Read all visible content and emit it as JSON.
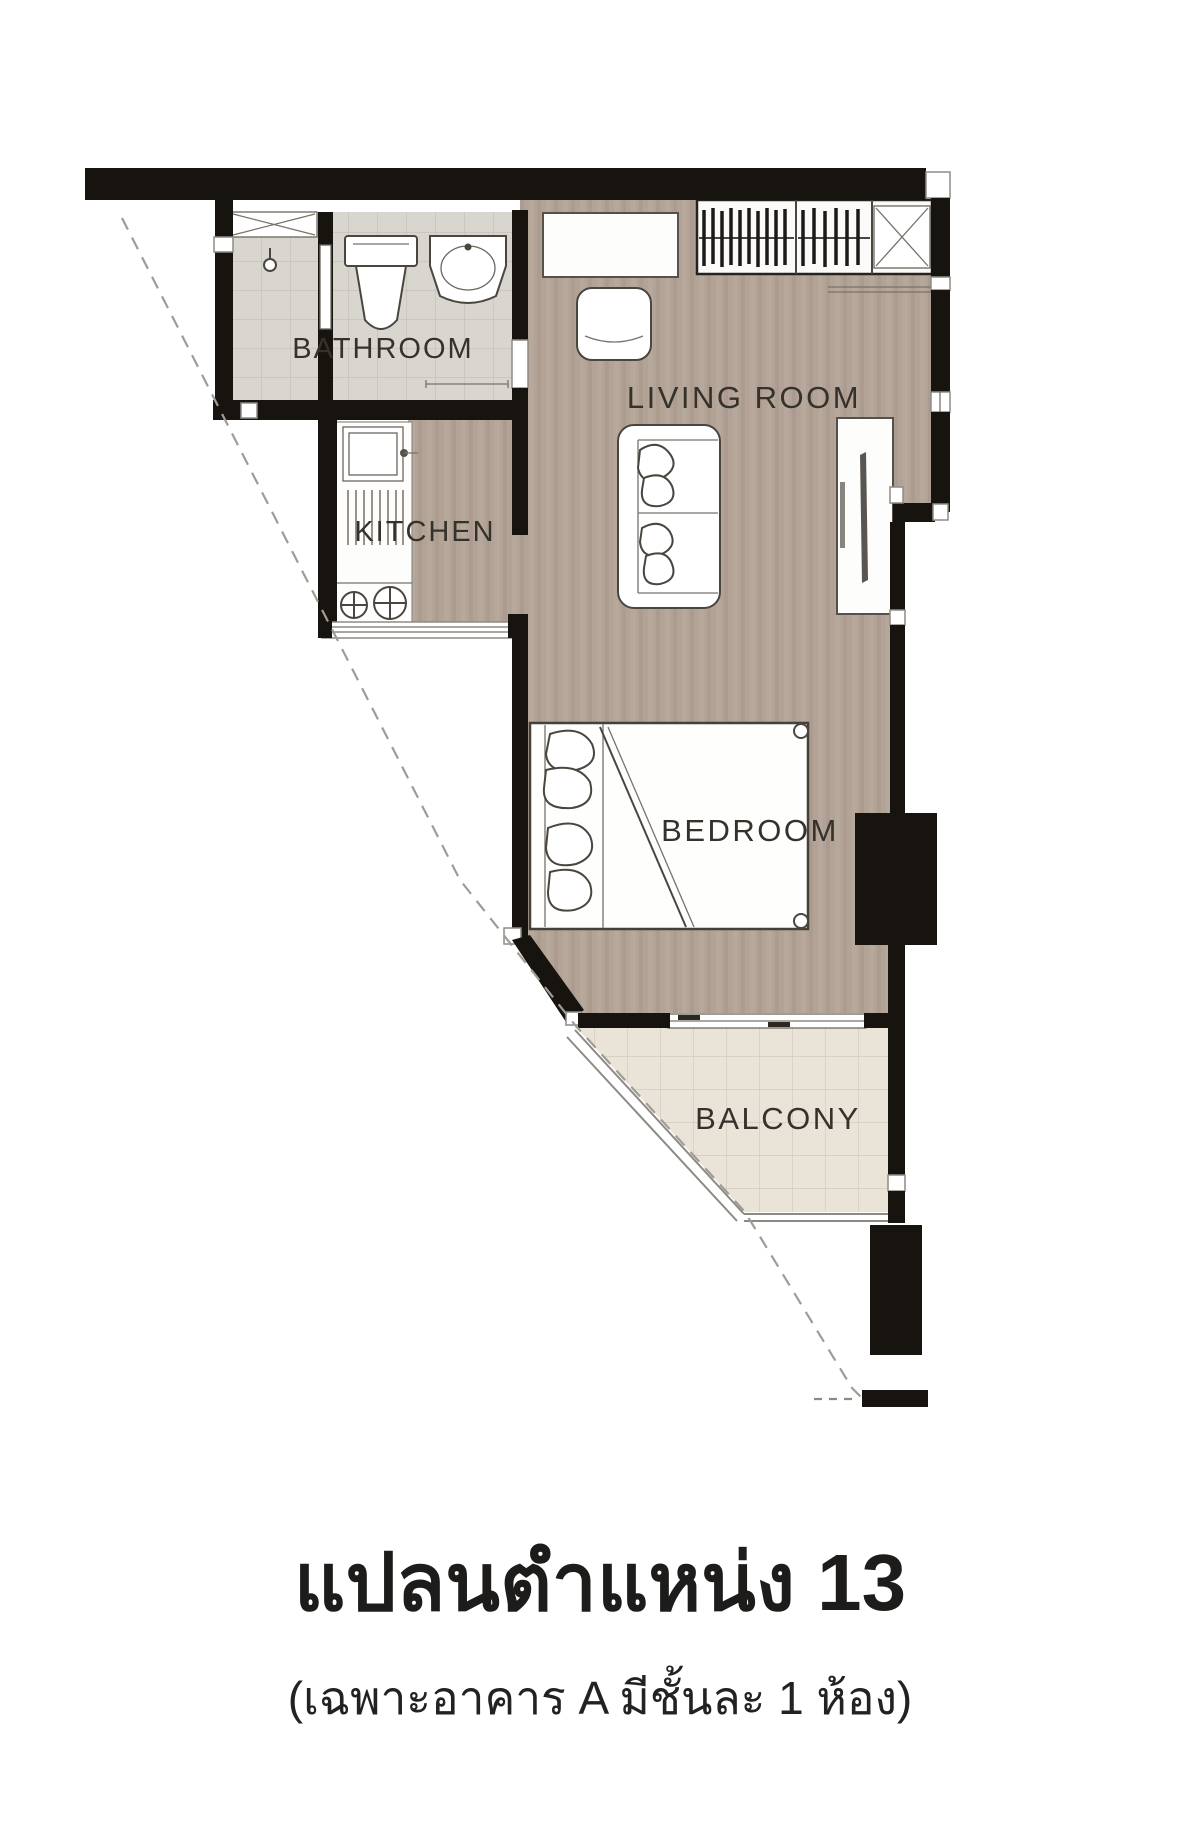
{
  "floor_plan": {
    "rooms": {
      "bathroom": {
        "label": "BATHROOM"
      },
      "kitchen": {
        "label": "KITCHEN"
      },
      "living_room": {
        "label": "LIVING ROOM"
      },
      "bedroom": {
        "label": "BEDROOM"
      },
      "balcony": {
        "label": "BALCONY"
      }
    },
    "colors": {
      "wall": "#17140f",
      "wood_floor": "#b2a396",
      "bathroom_tile": "#d9d6d0",
      "balcony_tile": "#eae3d8",
      "label_text": "#35312b"
    }
  },
  "caption": {
    "title": "แปลนตำแหน่ง 13",
    "subtitle": "(เฉพาะอาคาร A มีชั้นละ 1 ห้อง)"
  }
}
